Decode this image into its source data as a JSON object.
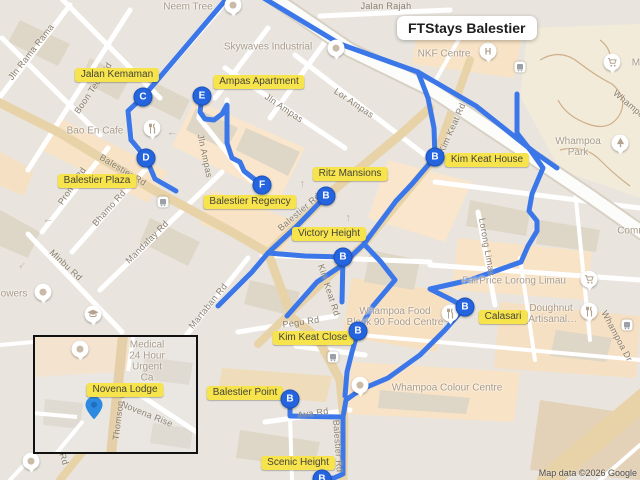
{
  "title_card": {
    "text": "FTStays Balestier"
  },
  "attribution": {
    "text": "Map data ©2026 Google"
  },
  "colors": {
    "route": "#3b77e8",
    "marker_fill": "#2464de",
    "label_bg": "#f7e34c",
    "label_text": "#45443b",
    "inset_pin": "#2d8ae0",
    "highway": "#fcfcfa",
    "major_road": "#e8d3a9"
  },
  "markers": [
    {
      "letter": "C",
      "x": 143,
      "y": 97,
      "name": "marker-c-jalan-kemaman"
    },
    {
      "letter": "E",
      "x": 202,
      "y": 96,
      "name": "marker-e-ampas-apartment"
    },
    {
      "letter": "D",
      "x": 146,
      "y": 158,
      "name": "marker-d-balestier-plaza"
    },
    {
      "letter": "F",
      "x": 262,
      "y": 185,
      "name": "marker-f-balestier-regency"
    },
    {
      "letter": "B",
      "x": 326,
      "y": 196,
      "name": "marker-b-ritz-mansions"
    },
    {
      "letter": "B",
      "x": 435,
      "y": 157,
      "name": "marker-b-kim-keat-house"
    },
    {
      "letter": "B",
      "x": 343,
      "y": 257,
      "name": "marker-b-victory-height"
    },
    {
      "letter": "B",
      "x": 465,
      "y": 307,
      "name": "marker-b-calasari"
    },
    {
      "letter": "B",
      "x": 358,
      "y": 331,
      "name": "marker-b-kim-keat-close"
    },
    {
      "letter": "B",
      "x": 290,
      "y": 399,
      "name": "marker-b-balestier-point"
    },
    {
      "letter": "B",
      "x": 322,
      "y": 479,
      "name": "marker-b-scenic-height"
    }
  ],
  "property_labels": [
    {
      "text": "Jalan Kemaman",
      "x": 117,
      "y": 75
    },
    {
      "text": "Ampas Apartment",
      "x": 259,
      "y": 82
    },
    {
      "text": "Balestier Plaza",
      "x": 97,
      "y": 181
    },
    {
      "text": "Balestier Regency",
      "x": 250,
      "y": 202
    },
    {
      "text": "Ritz Mansions",
      "x": 350,
      "y": 174
    },
    {
      "text": "Kim Keat House",
      "x": 487,
      "y": 160
    },
    {
      "text": "Victory Height",
      "x": 329,
      "y": 234
    },
    {
      "text": "Calasari",
      "x": 503,
      "y": 317
    },
    {
      "text": "Kim Keat Close",
      "x": 313,
      "y": 338
    },
    {
      "text": "Balestier Point",
      "x": 245,
      "y": 393
    },
    {
      "text": "Scenic Height",
      "x": 298,
      "y": 463
    }
  ],
  "poi_labels": [
    {
      "text": "Neem Tree",
      "x": 188,
      "y": 7,
      "pin": "dot",
      "px": 233,
      "py": 6
    },
    {
      "text": "Skywaves Industrial",
      "x": 268,
      "y": 47,
      "pin": "dot",
      "px": 336,
      "py": 49
    },
    {
      "text": "NKF Centre",
      "x": 444,
      "y": 54,
      "pin": "hospital",
      "px": 488,
      "py": 52
    },
    {
      "text": "Mi",
      "x": 637,
      "y": 63,
      "pin": "cart",
      "px": 612,
      "py": 63
    },
    {
      "text": "Whampoa Park",
      "x": 578,
      "y": 147,
      "pin": "tree",
      "px": 620,
      "py": 144
    },
    {
      "text": "Bao En Cafe",
      "x": 95,
      "y": 131,
      "pin": "food",
      "px": 152,
      "py": 129
    },
    {
      "text": "FairPrice Lorong Limau",
      "x": 514,
      "y": 281,
      "pin": "cart",
      "px": 589,
      "py": 280
    },
    {
      "text": "Doughnut\n(Artisanal…",
      "x": 551,
      "y": 314,
      "pin": "food",
      "px": 589,
      "py": 312
    },
    {
      "text": "Whampoa Food\nBlock 90 Food Centre",
      "x": 395,
      "y": 317,
      "pin": "food",
      "px": 450,
      "py": 314
    },
    {
      "text": "Whampoa Colour Centre",
      "x": 447,
      "y": 388,
      "pin": "dot",
      "px": 360,
      "py": 386
    },
    {
      "text": "Communit",
      "x": 640,
      "y": 231
    },
    {
      "text": "owers",
      "x": 14,
      "y": 294,
      "pin": "dot",
      "px": 43,
      "py": 293
    }
  ],
  "street_labels": [
    {
      "text": "Jln Rama Rama",
      "x": 31,
      "y": 52,
      "rot": -52
    },
    {
      "text": "Boon Teck Rd",
      "x": 93,
      "y": 88,
      "rot": -56
    },
    {
      "text": "Jalan Rajah",
      "x": 386,
      "y": 6,
      "rot": 0
    },
    {
      "text": "Jln Ampas",
      "x": 284,
      "y": 108,
      "rot": 34
    },
    {
      "text": "Jln Ampas",
      "x": 205,
      "y": 156,
      "rot": 78
    },
    {
      "text": "Lor Ampas",
      "x": 354,
      "y": 103,
      "rot": 34
    },
    {
      "text": "Balestier Rd",
      "x": 123,
      "y": 170,
      "rot": 31
    },
    {
      "text": "Balestier Rd",
      "x": 299,
      "y": 212,
      "rot": -41
    },
    {
      "text": "Balestier Rd",
      "x": 338,
      "y": 446,
      "rot": 86
    },
    {
      "text": "Kim Keat Rd",
      "x": 452,
      "y": 128,
      "rot": -66
    },
    {
      "text": "Kim Keat Rd",
      "x": 329,
      "y": 290,
      "rot": 72
    },
    {
      "text": "Bhamo Rd",
      "x": 109,
      "y": 208,
      "rot": -48
    },
    {
      "text": "Prome Rd",
      "x": 72,
      "y": 186,
      "rot": -56
    },
    {
      "text": "Mandalay Rd",
      "x": 147,
      "y": 242,
      "rot": -45
    },
    {
      "text": "Minbu Rd",
      "x": 66,
      "y": 265,
      "rot": 43
    },
    {
      "text": "Martaban Rd",
      "x": 208,
      "y": 306,
      "rot": -51
    },
    {
      "text": "Pegu Rd",
      "x": 301,
      "y": 322,
      "rot": -8
    },
    {
      "text": "Ava Rd",
      "x": 313,
      "y": 413,
      "rot": -8
    },
    {
      "text": "Lorong Limau",
      "x": 487,
      "y": 247,
      "rot": 80
    },
    {
      "text": "Whampoa Dr",
      "x": 617,
      "y": 336,
      "rot": 62
    },
    {
      "text": "Whampo",
      "x": 629,
      "y": 104,
      "rot": 40
    },
    {
      "text": "Rd",
      "x": 64,
      "y": 459,
      "rot": 72
    }
  ],
  "icons": [
    {
      "type": "bus",
      "x": 163,
      "y": 202
    },
    {
      "type": "bus",
      "x": 333,
      "y": 357
    },
    {
      "type": "bus",
      "x": 520,
      "y": 67
    },
    {
      "type": "bus",
      "x": 627,
      "y": 325
    },
    {
      "type": "school",
      "x": 93,
      "y": 315
    },
    {
      "type": "dot-pin",
      "x": 31,
      "y": 462
    },
    {
      "type": "arrow",
      "x": 172,
      "y": 135,
      "rot": 180
    },
    {
      "type": "arrow",
      "x": 48,
      "y": 222,
      "rot": 180
    },
    {
      "type": "arrow",
      "x": 347,
      "y": 218,
      "rot": -90
    },
    {
      "type": "arrow",
      "x": 301,
      "y": 184,
      "rot": -90
    },
    {
      "type": "arrow",
      "x": 23,
      "y": 266,
      "rot": 135
    }
  ],
  "routes": [
    {
      "name": "route-jalan-kemaman",
      "points": [
        [
          228,
          -3
        ],
        [
          143,
          97
        ],
        [
          128,
          111
        ],
        [
          131,
          140
        ],
        [
          146,
          158
        ],
        [
          155,
          179
        ],
        [
          176,
          191
        ]
      ]
    },
    {
      "name": "route-ampas-apartment",
      "points": [
        [
          202,
          96
        ],
        [
          200,
          112
        ],
        [
          205,
          119
        ],
        [
          214,
          120
        ],
        [
          222,
          114
        ],
        [
          227,
          105
        ],
        [
          227,
          143
        ],
        [
          232,
          158
        ],
        [
          240,
          162
        ],
        [
          244,
          171
        ],
        [
          262,
          185
        ]
      ]
    },
    {
      "name": "route-cte-highway",
      "points": [
        [
          262,
          -3
        ],
        [
          340,
          44
        ],
        [
          418,
          72
        ],
        [
          476,
          106
        ],
        [
          534,
          152
        ],
        [
          557,
          168
        ]
      ]
    },
    {
      "name": "route-kim-keat-branch",
      "points": [
        [
          418,
          72
        ],
        [
          428,
          98
        ],
        [
          434,
          128
        ],
        [
          435,
          157
        ]
      ]
    },
    {
      "name": "route-kim-keat-rd",
      "points": [
        [
          435,
          157
        ],
        [
          412,
          184
        ],
        [
          396,
          201
        ],
        [
          364,
          244
        ],
        [
          341,
          266
        ],
        [
          317,
          282
        ],
        [
          287,
          316
        ]
      ]
    },
    {
      "name": "route-whampoa-east",
      "points": [
        [
          517,
          94
        ],
        [
          517,
          133
        ],
        [
          531,
          151
        ],
        [
          543,
          168
        ],
        [
          532,
          194
        ],
        [
          529,
          211
        ],
        [
          537,
          221
        ],
        [
          537,
          231
        ],
        [
          528,
          246
        ],
        [
          521,
          262
        ],
        [
          470,
          280
        ],
        [
          430,
          289
        ],
        [
          448,
          298
        ],
        [
          465,
          307
        ]
      ]
    },
    {
      "name": "route-balestier-ritz",
      "points": [
        [
          326,
          196
        ],
        [
          297,
          226
        ],
        [
          268,
          253
        ],
        [
          252,
          272
        ],
        [
          232,
          292
        ],
        [
          218,
          306
        ]
      ]
    },
    {
      "name": "route-victory-horiz",
      "points": [
        [
          268,
          253
        ],
        [
          305,
          256
        ],
        [
          343,
          257
        ]
      ]
    },
    {
      "name": "route-victory-vert",
      "points": [
        [
          343,
          257
        ],
        [
          342,
          302
        ]
      ]
    },
    {
      "name": "route-food-centre",
      "points": [
        [
          364,
          244
        ],
        [
          381,
          262
        ],
        [
          395,
          280
        ],
        [
          373,
          306
        ],
        [
          358,
          331
        ]
      ]
    },
    {
      "name": "route-calasari-south",
      "points": [
        [
          465,
          307
        ],
        [
          445,
          330
        ],
        [
          420,
          355
        ],
        [
          388,
          378
        ],
        [
          360,
          390
        ],
        [
          346,
          400
        ],
        [
          343,
          417
        ],
        [
          343,
          474
        ],
        [
          334,
          478
        ],
        [
          324,
          479
        ]
      ]
    },
    {
      "name": "route-kim-keat-close",
      "points": [
        [
          358,
          331
        ],
        [
          352,
          352
        ],
        [
          347,
          372
        ],
        [
          345,
          396
        ]
      ]
    },
    {
      "name": "route-balestier-point",
      "points": [
        [
          290,
          399
        ],
        [
          290,
          416
        ],
        [
          340,
          417
        ]
      ]
    }
  ],
  "inset": {
    "poi": {
      "text": "Thomson Medical\n24 Hour Urgent Ca",
      "x": 112,
      "y": 19,
      "pin": "dot",
      "px": 45,
      "py": 13
    },
    "property_label": {
      "text": "Novena Lodge",
      "x": 90,
      "y": 53
    },
    "streets": [
      {
        "text": "Thomson Rd",
        "x": 84,
        "y": 76,
        "rot": -83
      },
      {
        "text": "Novena Rise",
        "x": 112,
        "y": 77,
        "rot": 22
      }
    ],
    "pin": {
      "x": 59,
      "y": 86
    }
  }
}
